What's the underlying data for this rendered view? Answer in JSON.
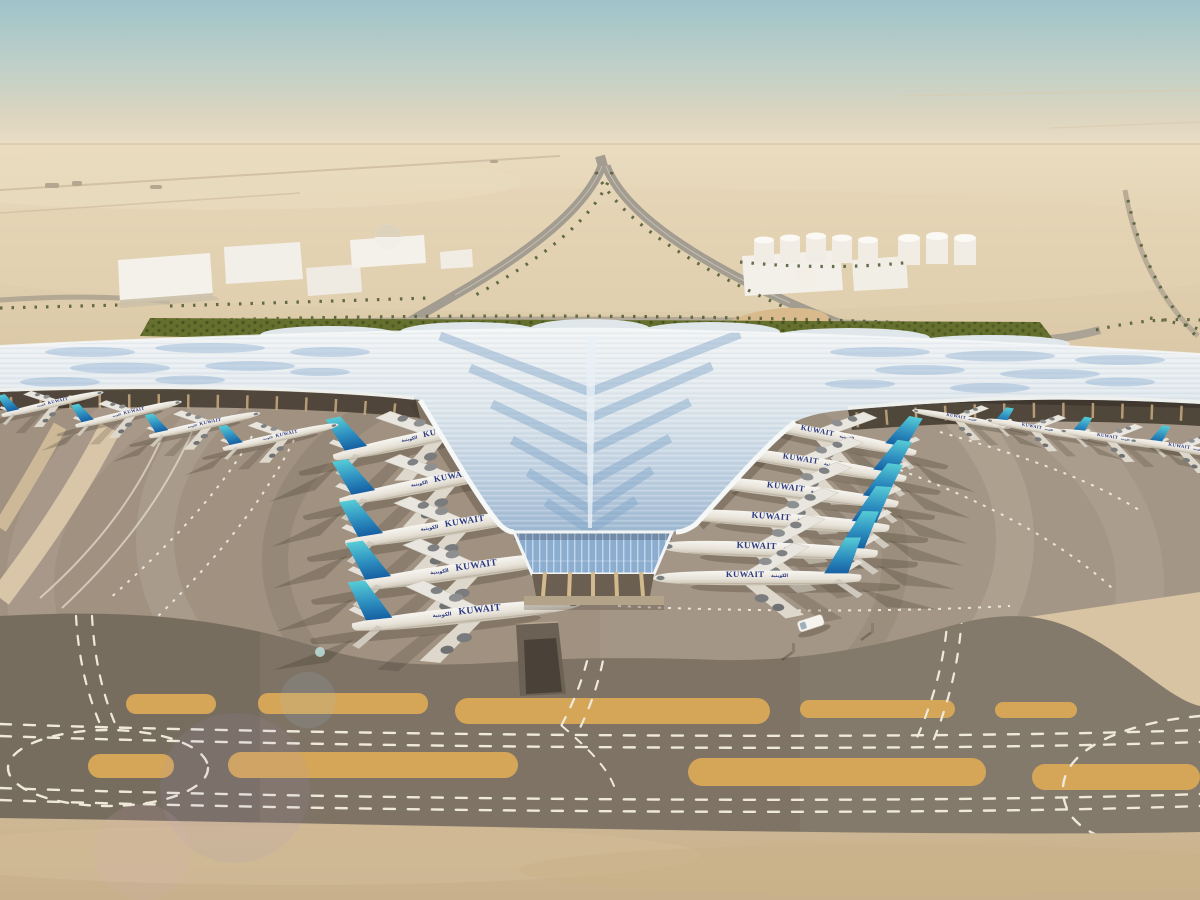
{
  "scene": {
    "name": "Aerial rendering of Kuwait International Airport winged terminal",
    "setting": "desert airfield under hazy teal sky",
    "sky_colors": {
      "top": "#9fc3c9",
      "horizon": "#ecdfc6"
    },
    "desert_color": "#e0cfae",
    "apron_color": "#a09181",
    "taxiway_color": "#7e7365",
    "island_paint_color": "#d5a658",
    "roof_base_color": "#e9eef1",
    "roof_glass_color": "#8fb3d8",
    "landscape_green": "#66702e"
  },
  "aircraft": {
    "title": "KUWAIT",
    "title_arabic": "الكويتية",
    "tail_colors": [
      "#56ccd6",
      "#1660a2"
    ],
    "counts": {
      "left_apron": 5,
      "right_apron": 6,
      "left_wing_gates": 4,
      "right_wing_gates": 4
    },
    "fleet": [
      {
        "x": 430,
        "y": 437,
        "r": -12,
        "s": 0.88,
        "heading": "e"
      },
      {
        "x": 441,
        "y": 482,
        "r": -11,
        "s": 0.92,
        "heading": "e"
      },
      {
        "x": 452,
        "y": 527,
        "r": -9,
        "s": 0.96,
        "heading": "e"
      },
      {
        "x": 463,
        "y": 571,
        "r": -8,
        "s": 1.0,
        "heading": "e"
      },
      {
        "x": 466,
        "y": 615,
        "r": -6,
        "s": 1.02,
        "heading": "e"
      },
      {
        "x": 828,
        "y": 436,
        "r": 11,
        "s": 0.8,
        "heading": "w"
      },
      {
        "x": 812,
        "y": 464,
        "r": 9,
        "s": 0.85,
        "heading": "w"
      },
      {
        "x": 798,
        "y": 492,
        "r": 7,
        "s": 0.9,
        "heading": "w"
      },
      {
        "x": 784,
        "y": 521,
        "r": 4,
        "s": 0.94,
        "heading": "w"
      },
      {
        "x": 770,
        "y": 550,
        "r": 2,
        "s": 0.96,
        "heading": "w"
      },
      {
        "x": 758,
        "y": 578,
        "r": 0,
        "s": 0.92,
        "heading": "w"
      },
      {
        "x": 52,
        "y": 404,
        "r": -13,
        "s": 0.46,
        "heading": "e"
      },
      {
        "x": 128,
        "y": 414,
        "r": -13,
        "s": 0.48,
        "heading": "e"
      },
      {
        "x": 204,
        "y": 425,
        "r": -12,
        "s": 0.5,
        "heading": "e"
      },
      {
        "x": 280,
        "y": 437,
        "r": -12,
        "s": 0.52,
        "heading": "e"
      },
      {
        "x": 962,
        "y": 419,
        "r": 10,
        "s": 0.44,
        "heading": "w"
      },
      {
        "x": 1038,
        "y": 429,
        "r": 10,
        "s": 0.46,
        "heading": "w"
      },
      {
        "x": 1114,
        "y": 439,
        "r": 9,
        "s": 0.48,
        "heading": "w"
      },
      {
        "x": 1186,
        "y": 449,
        "r": 9,
        "s": 0.5,
        "heading": "w"
      }
    ]
  },
  "background": {
    "warehouse_count": 6,
    "fuel_tank_count": 9,
    "dome_count": 1,
    "palm_lined_roads": true
  },
  "vehicle": {
    "type": "service-vehicle",
    "color": "#f6f4ef"
  }
}
